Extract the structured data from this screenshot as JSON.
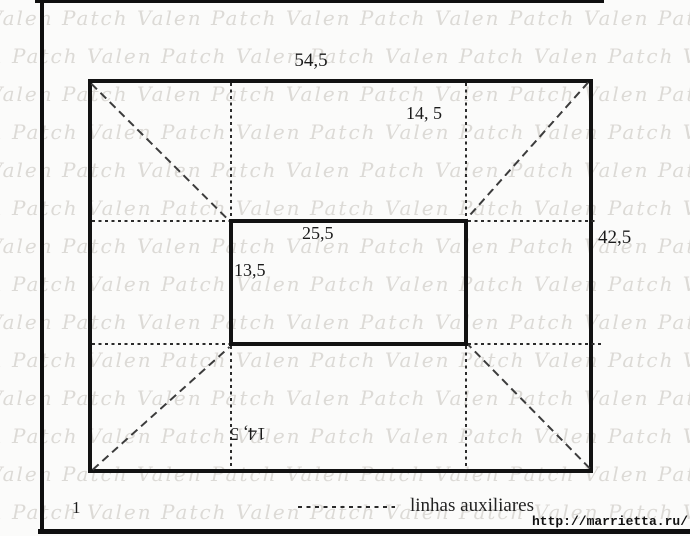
{
  "watermark": {
    "text": "Valen Patch",
    "rows": 14,
    "repeat": 8,
    "row_spacing_px": 38,
    "color": "#dcdad6"
  },
  "figure": {
    "number": "1",
    "labels": {
      "outer_width": "54,5",
      "outer_height": "42,5",
      "inner_width": "25,5",
      "inner_height": "13,5",
      "margin_top": "14, 5",
      "margin_bottom": "14, 5"
    },
    "legend": {
      "label": "linhas auxiliares"
    },
    "source": "http://marrietta.ru/"
  },
  "colors": {
    "line": "#121212",
    "auxiliary_line": "#2b2b2b",
    "background": "#fbfbfa"
  }
}
